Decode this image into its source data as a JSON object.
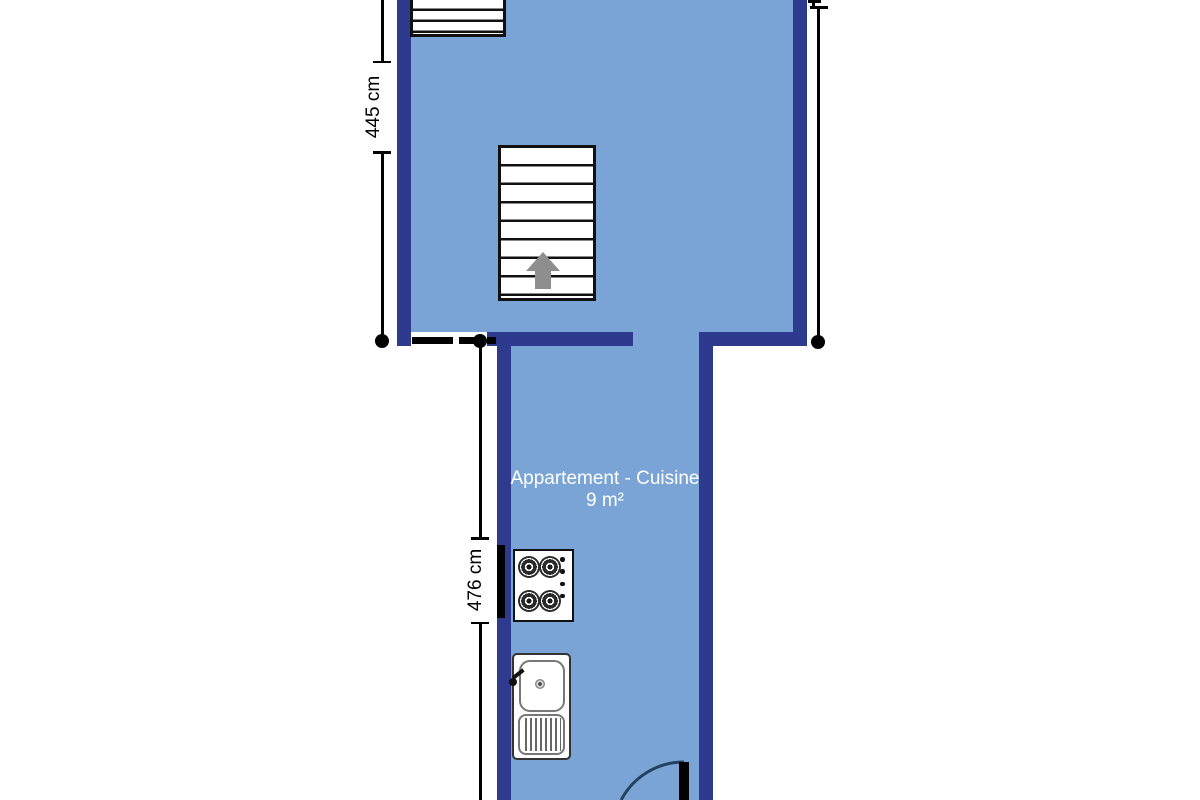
{
  "floor_plan": {
    "room_label": {
      "name": "Appartement - Cuisine",
      "area": "9 m²"
    },
    "dimensions": {
      "left_wall": "445 cm",
      "kitchen_length": "476 cm"
    },
    "icons": {
      "staircase_main": "staircase-with-up-arrow",
      "staircase_small": "staircase-partial-top",
      "stove": "stove-4-burner-cooktop",
      "sink": "kitchen-sink-with-drainboard",
      "door": "door-swing-arc",
      "opening": "dashed-wall-opening"
    },
    "colors": {
      "floor_fill": "#7aa4d5",
      "wall": "#2d3a8e",
      "label_text": "#ffffff",
      "dimension": "#000000",
      "stair_outline": "#111111",
      "direction_arrow": "#8e8e8e",
      "door_swing": "#24415e"
    }
  }
}
